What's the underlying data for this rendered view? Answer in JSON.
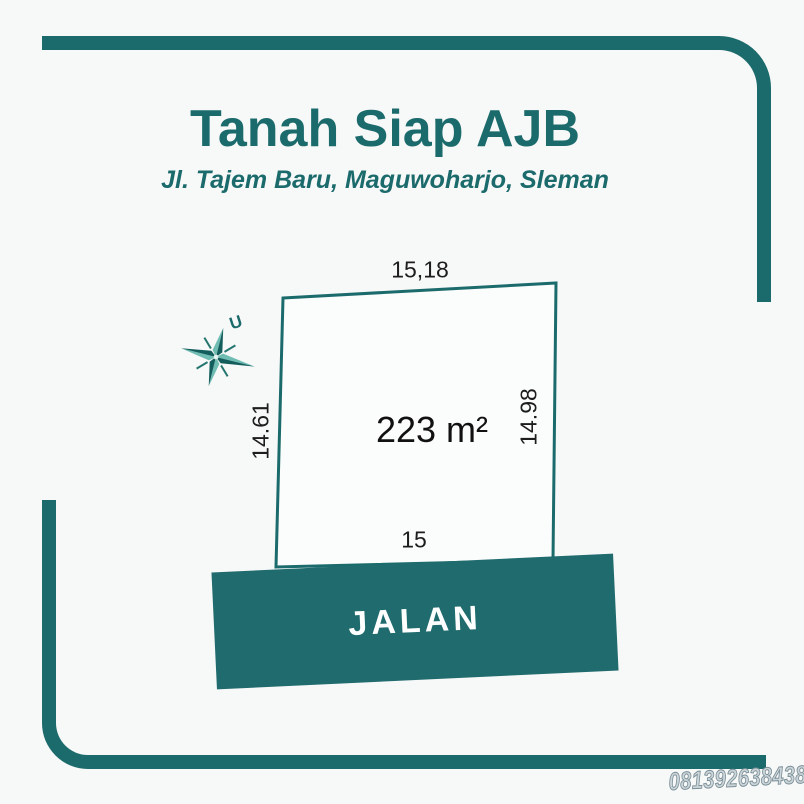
{
  "colors": {
    "teal": "#1c6b6c",
    "teal_dark": "#135e5c",
    "teal_light": "#6fbdb2",
    "ink": "#1d1d1d",
    "bg": "#f7f8f8",
    "road_fill": "#206b6e",
    "road_text": "#ffffff",
    "phone_fill": "#ccd6da",
    "phone_stroke": "#7b8f97",
    "plot_fill": "#fbfcfc"
  },
  "header": {
    "title": "Tanah Siap AJB",
    "subtitle": "Jl. Tajem Baru, Maguwoharjo, Sleman"
  },
  "plot": {
    "area_label": "223 m²",
    "dimensions": {
      "top": "15,18",
      "left": "14.61",
      "right": "14.98",
      "bottom": "15"
    }
  },
  "compass": {
    "north_label": "U"
  },
  "road": {
    "label": "JALAN"
  },
  "contact": {
    "phone": "081392638438"
  }
}
